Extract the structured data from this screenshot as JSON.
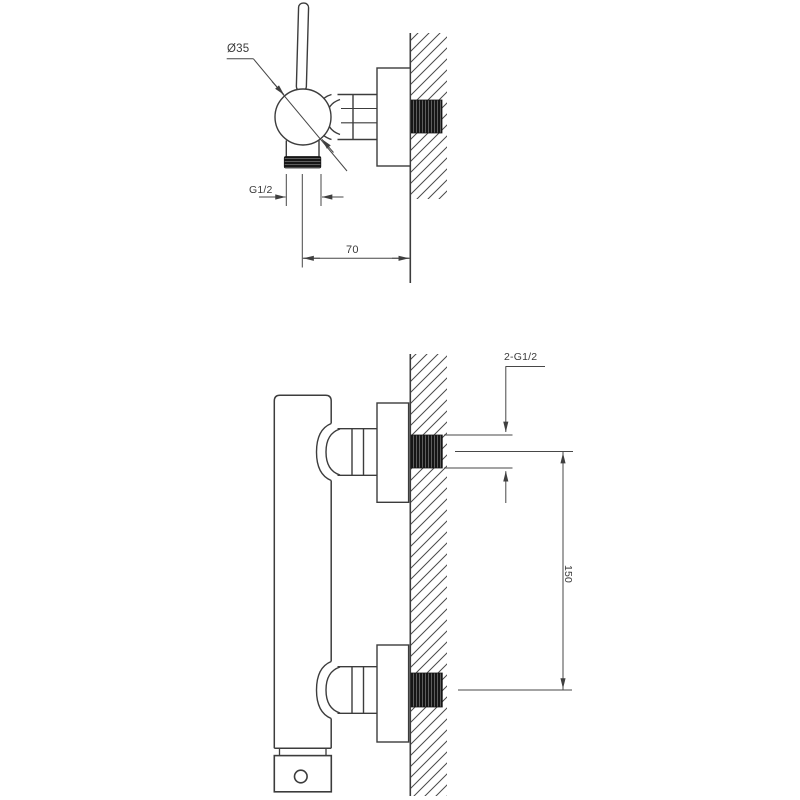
{
  "labels": {
    "body_diameter": "Ø35",
    "outlet_thread": "G1/2",
    "wall_offset": "70",
    "inlet_thread": "2-G1/2",
    "inlet_spacing": "150"
  },
  "colors": {
    "line": "#3c3c3c",
    "dimension": "#474747",
    "text": "#3a3a3a",
    "thread_fill": "#161616",
    "background": "#ffffff"
  }
}
